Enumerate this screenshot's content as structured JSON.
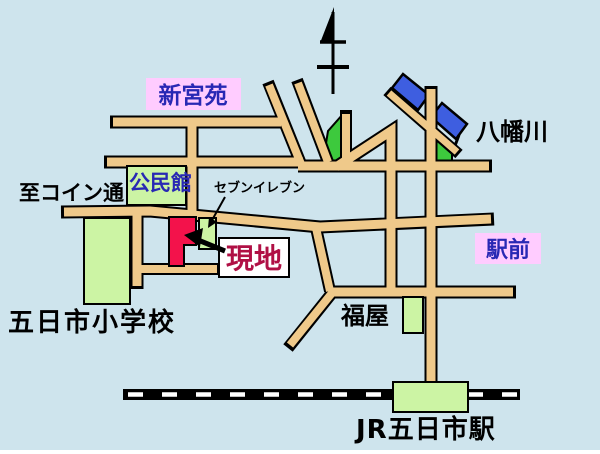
{
  "map": {
    "colors": {
      "background": "#CEE4ED",
      "road": "#EFC98A",
      "road_outline": "#000000",
      "river_blue": "#3E5EE0",
      "park_green": "#3DC93D",
      "building_green": "#CCF4A4",
      "site_red": "#F3124B",
      "label_pink": "#FFCCFF",
      "label_navy": "#2828B4",
      "genchi_crimson": "#B01045",
      "text_black": "#000000",
      "label_white": "#FFFFFF",
      "railway_black": "#000000",
      "railway_dash_white": "#FFFFFF"
    },
    "labels": {
      "shinguen": {
        "text": "新宮苑"
      },
      "yahatagawa": {
        "text": "八幡川"
      },
      "to_coin_street": {
        "text": "至コイン通"
      },
      "kominkan": {
        "text": "公民館"
      },
      "seven_eleven": {
        "text": "セブンイレブン"
      },
      "genchi": {
        "text": "現地"
      },
      "ekimae": {
        "text": "駅前"
      },
      "fukuya": {
        "text": "福屋"
      },
      "elementary_school": {
        "text": "五日市小学校"
      },
      "jr_station": {
        "text": "JR五日市駅"
      }
    }
  }
}
